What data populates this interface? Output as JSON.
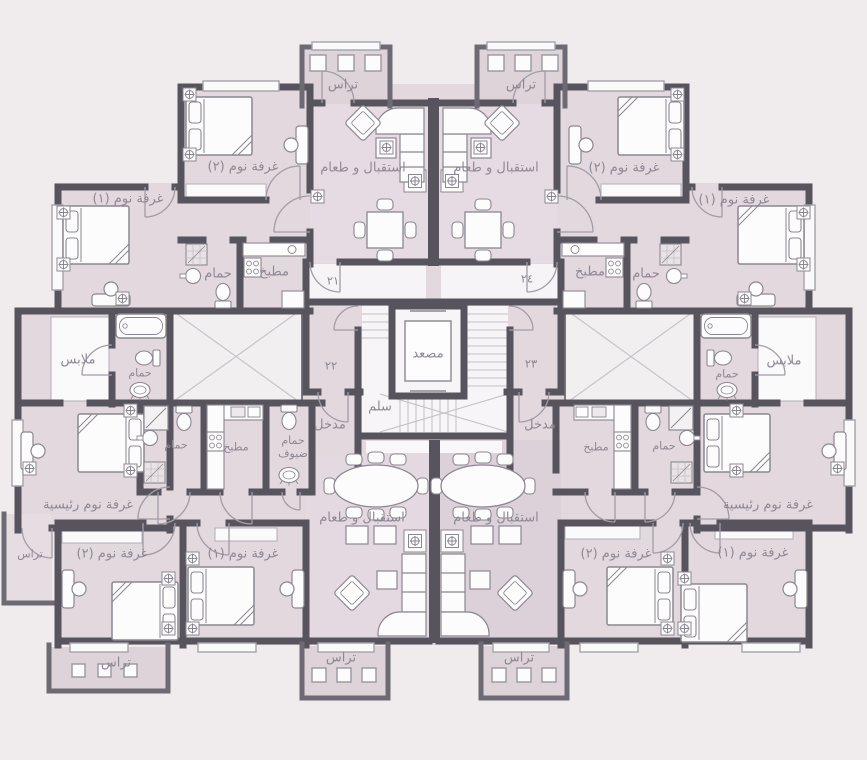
{
  "floor_plan": {
    "rooms": {
      "terrace": "تراس",
      "bedroom_1": "غرفة نوم (١)",
      "bedroom_2": "غرفة نوم (٢)",
      "master_bedroom": "غرفة نوم رئيسية",
      "reception_dining": "استقبال و طعام",
      "bathroom": "حمام",
      "guest_bathroom": "حمام ضيوف",
      "kitchen": "مطبخ",
      "dressing": "ملابس",
      "entrance": "مدخل",
      "elevator": "مصعد",
      "stairs": "سلم"
    },
    "units": {
      "unit_21": "٢١",
      "unit_22": "٢٢",
      "unit_23": "٢٣",
      "unit_24": "٢٤"
    },
    "colors": {
      "background": "#f0ecee",
      "room_fill": "#e2d8de",
      "reception_fill": "#e6dbe2",
      "terrace_fill": "#ddd3d9",
      "shaft_fill": "#f2eff1",
      "wall": "#57545d",
      "furniture_stroke": "#8b8790",
      "label_text": "#8e8894",
      "white": "#fdfcfd"
    }
  }
}
